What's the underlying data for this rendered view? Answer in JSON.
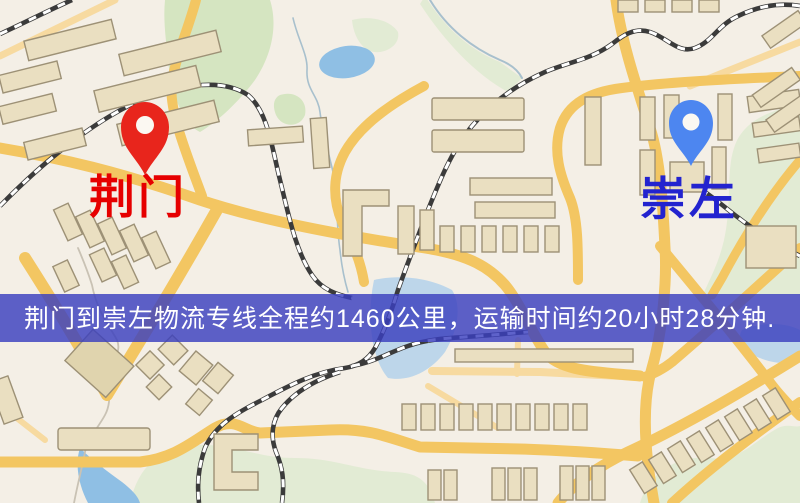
{
  "banner": {
    "text": "荆门到崇左物流专线全程约1460公里，运输时间约20小时28分钟.",
    "bg_color": "#3a3fbe",
    "text_color": "#ffffff"
  },
  "markers": {
    "origin": {
      "label": "荆门",
      "pin_color": "#e8251c",
      "label_color": "#e60000"
    },
    "destination": {
      "label": "崇左",
      "pin_color": "#4d86f0",
      "label_color": "#2323cf"
    }
  },
  "map_colors": {
    "background": "#f4efe6",
    "park": "#d5e5c1",
    "park_light": "#e2ebd4",
    "water": "#8fbfe4",
    "water_light": "#bdd6ea",
    "road": "#f3c662",
    "road_minor": "#f7daa0",
    "building_fill": "#eadfc1",
    "building_stroke": "#9d9176",
    "railway": "#3b3b3b",
    "stream": "#a8c0cd",
    "footpath": "#c9c2b4"
  }
}
